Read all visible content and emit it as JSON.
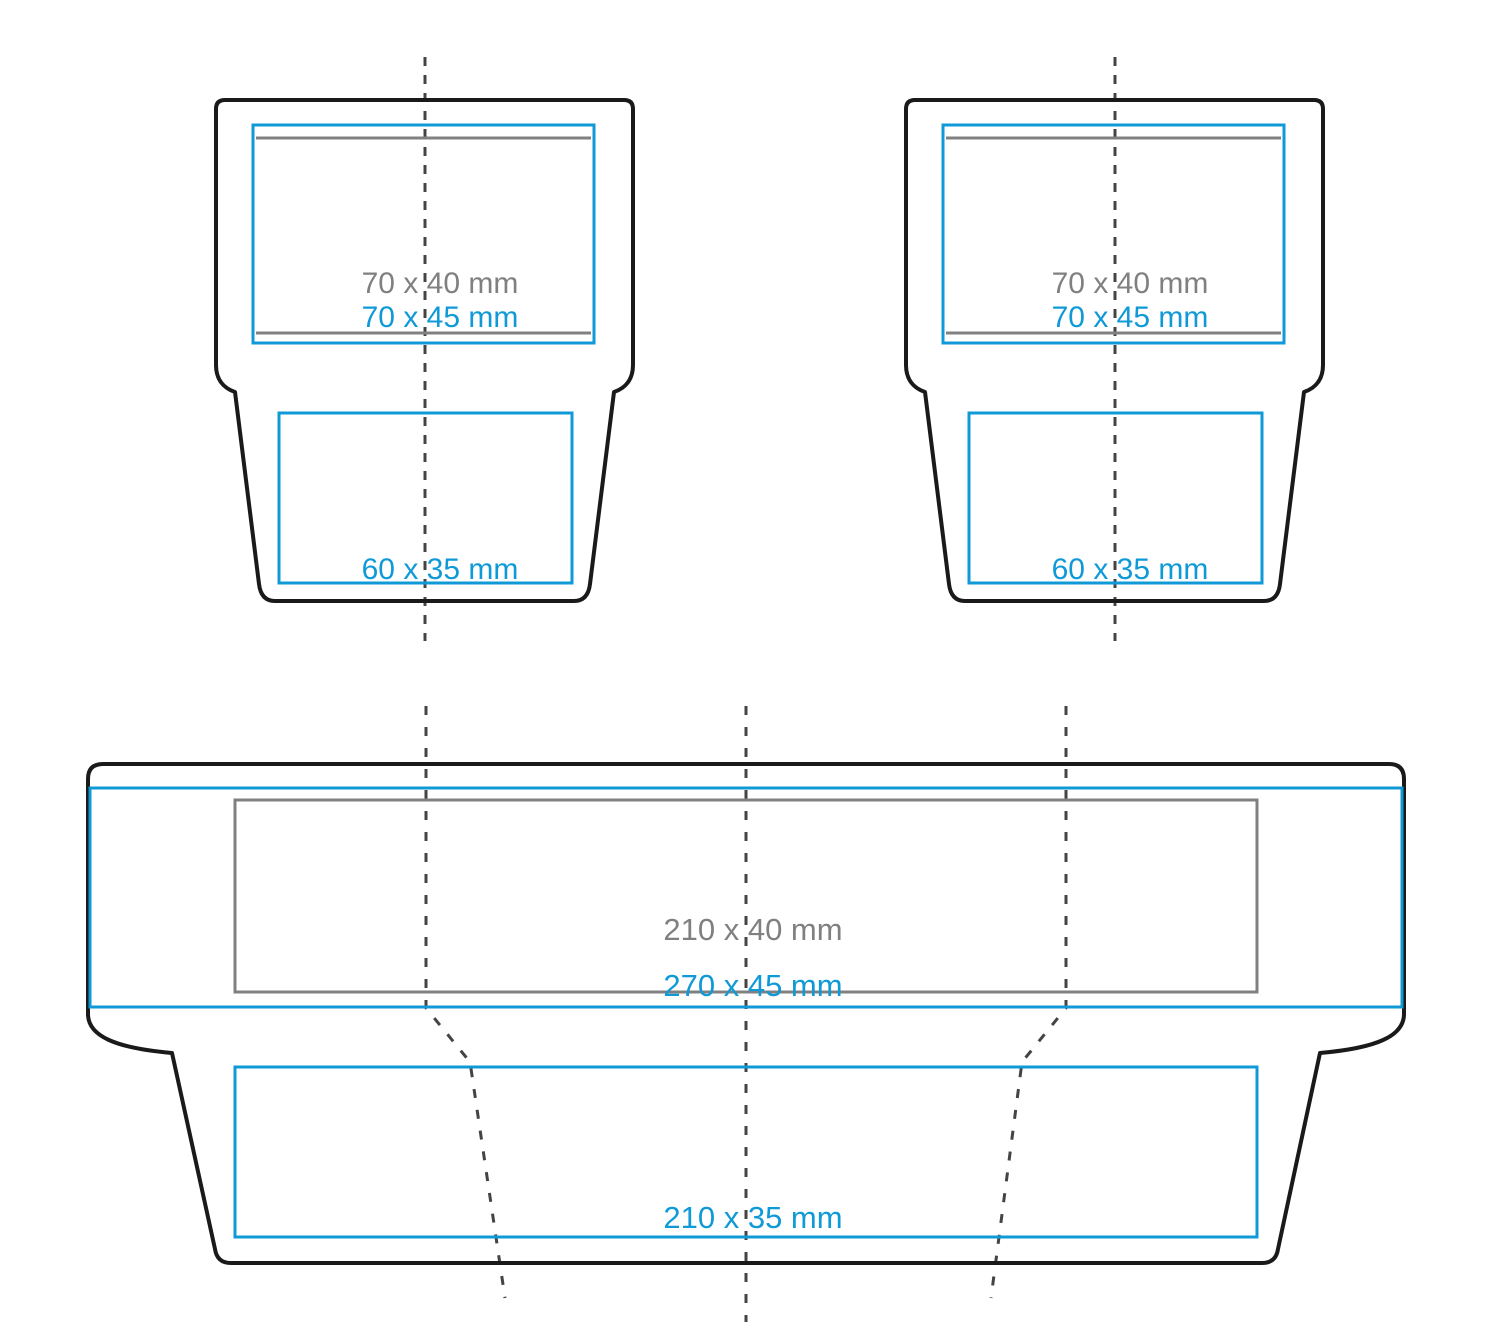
{
  "diagram_title": "envelope dieline print-area template",
  "canvas": {
    "width": 1500,
    "height": 1344
  },
  "colors": {
    "outline": "#1a1a1a",
    "print_zone_blue": "#0f9ad7",
    "print_zone_gray": "#808080",
    "fold_line": "#444444",
    "background": "#ffffff"
  },
  "shapes": {
    "top_left": {
      "zone_gray_label": "70 x 40 mm",
      "zone_blue_label": "70 x 45 mm",
      "front_zone_label": "60 x 35 mm"
    },
    "top_right": {
      "zone_gray_label": "70 x 40 mm",
      "zone_blue_label": "70 x 45 mm",
      "front_zone_label": "60 x 35 mm"
    },
    "bottom": {
      "zone_gray_label": "210 x 40 mm",
      "zone_blue_label": "270 x 45 mm",
      "front_zone_label": "210 x 35 mm"
    }
  }
}
